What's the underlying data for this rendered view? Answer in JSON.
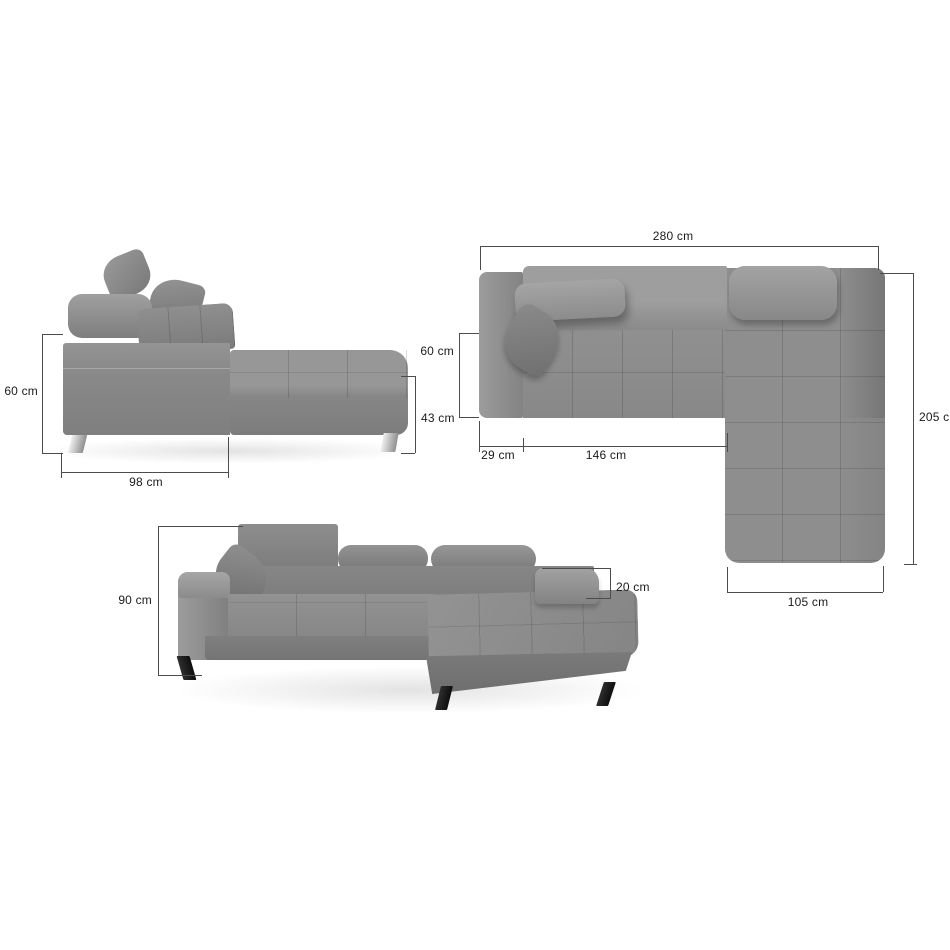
{
  "diagram": {
    "subject": "corner-sofa-dimension-diagram",
    "unit": "cm",
    "views": {
      "side": {
        "title": "side-view",
        "dims": {
          "height": "60 cm",
          "length": "98 cm",
          "chaise_height": "43 cm"
        }
      },
      "top": {
        "title": "top-view",
        "dims": {
          "width": "280 cm",
          "seat_depth": "60 cm",
          "depth": "205 cm",
          "armrest_width": "29 cm",
          "seat_width": "146 cm",
          "chaise_width": "105 cm"
        }
      },
      "perspective": {
        "title": "perspective-view",
        "dims": {
          "height": "90 cm",
          "armrest_height": "20 cm"
        }
      }
    },
    "colors": {
      "background": "#ffffff",
      "fabric": "#8c8c8c",
      "fabric_light": "#9e9e9e",
      "fabric_dark": "#767676",
      "dimension_line": "#4c4c4c",
      "text": "#1b1b1b",
      "leg_chrome": "#d6d6d6",
      "leg_black": "#1a1a1a"
    }
  }
}
